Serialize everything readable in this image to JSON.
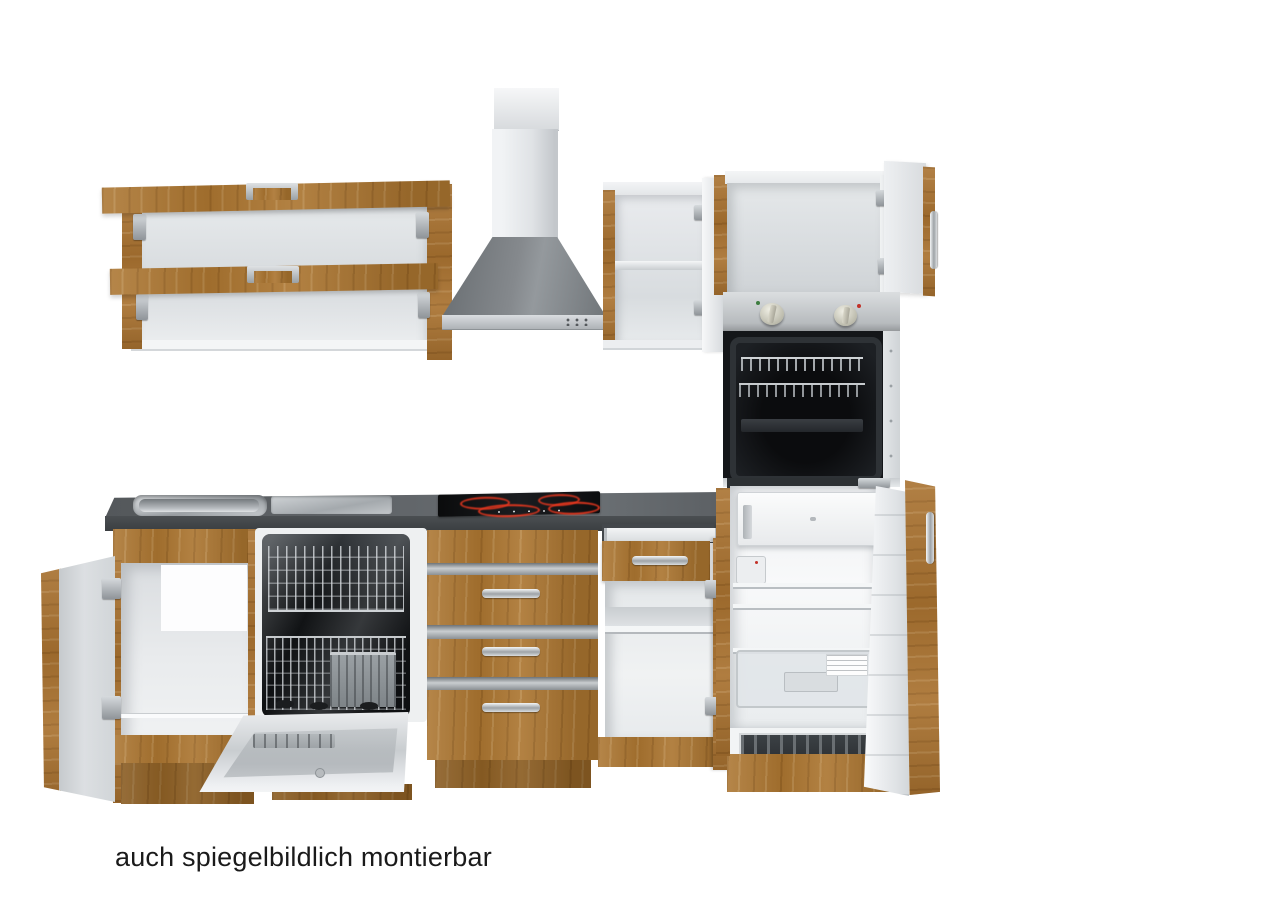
{
  "caption": {
    "text": "auch spiegelbildlich montierbar"
  },
  "palette": {
    "background": "#ffffff",
    "wood": "#ab7530",
    "wood_dark": "#8a5e24",
    "countertop": "#5d6164",
    "countertop_edge": "#43474a",
    "cabinet_interior": "#edeff1",
    "stainless": "#c6cacd",
    "oven_black": "#121417",
    "burner_red": "#e03a22",
    "door_inner_grey": "#d3d6d9"
  },
  "scene": {
    "type": "kitchen-unit-product-photo",
    "appliances": [
      "range-hood",
      "oven",
      "cooktop",
      "dishwasher",
      "fridge"
    ],
    "note_text": "auch spiegelbildlich montierbar"
  }
}
